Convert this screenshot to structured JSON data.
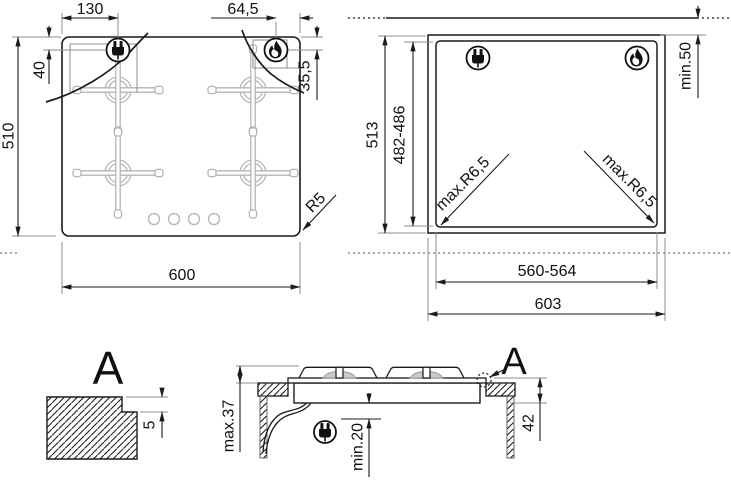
{
  "dims": {
    "plug_offset_x": "130",
    "flame_offset_x": "64,5",
    "plug_offset_y": "40",
    "flame_offset_y": "35,5",
    "hob_depth": "510",
    "hob_width": "600",
    "hob_corner_radius": "R5",
    "worktop_depth": "513",
    "cutout_depth": "482-486",
    "wall_clearance": "min.50",
    "cutout_corner_radius": "max.R6,5",
    "cutout_width": "560-564",
    "worktop_width": "603",
    "detail_step": "5",
    "section_height_above": "max.37",
    "section_clearance_below": "min.20",
    "section_depth": "42"
  },
  "labels": {
    "detail": "A",
    "section_detail": "A"
  },
  "colors": {
    "line": "#1a1a1a",
    "light_gray": "#b5b5b5",
    "background": "#ffffff"
  }
}
